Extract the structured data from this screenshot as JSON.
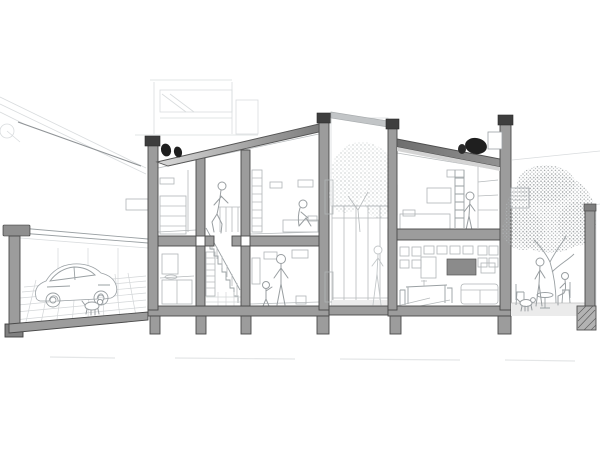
{
  "meta": {
    "title": "Architectural sectional perspective drawing of a two-storey house",
    "drawing_type": "building cross-section, monochrome line drawing",
    "canvas": {
      "width": 600,
      "height": 450,
      "background": "#ffffff"
    },
    "alt": "Black-and-white architectural section: carport with car at left, two-storey dwelling with staircase, bathroom and bedrooms, planted courtyard, living-dining room, loft bedroom, and right garden with large tree, outdoor furniture, people and a dog. Cut walls in grey with dark caps, footings below ground, rooftop equipment in black."
  },
  "palette": {
    "wall_poche": "#9c9c9c",
    "wall_outline": "#4a4a4a",
    "wall_cap": "#3e3e3e",
    "roof_gradient_light": "#d8d8d8",
    "roof_gradient_dark": "#7d7d7d",
    "roof_right_dark": "#707070",
    "equipment_black": "#1f1f1f",
    "interior_line": "#b6babc",
    "background_line": "#d9dcde",
    "foliage_dot": "#a9adaf",
    "ground_tint": "#ebebeb"
  },
  "scene": {
    "zones": [
      {
        "name": "neighbor-roof",
        "desc": "faint sloping roof of adjacent building, upper left"
      },
      {
        "name": "carport",
        "desc": "open garage with car, small dog and tiled perspective floor"
      },
      {
        "name": "left-building",
        "desc": "two-storey volume: bathroom, stair hall, family room below; bedrooms above"
      },
      {
        "name": "courtyard",
        "desc": "glazed lightwell with tree and faint figure"
      },
      {
        "name": "right-building",
        "desc": "loft bedroom over living-dining room with bookshelf wall"
      },
      {
        "name": "garden",
        "desc": "right garden with large stippled tree, table, chairs, figures, dog, boundary wall"
      }
    ],
    "figures": [
      {
        "name": "figure-climbing-stairs",
        "location": "stair hall, upper flight"
      },
      {
        "name": "figure-sitting-bedroom",
        "location": "upper bedroom, seated on bed"
      },
      {
        "name": "figure-adult-standing",
        "location": "ground-floor family room"
      },
      {
        "name": "figure-child",
        "location": "ground-floor family room"
      },
      {
        "name": "figure-courtyard",
        "location": "behind courtyard glazing"
      },
      {
        "name": "figure-bedroom-right",
        "location": "right loft bedroom"
      },
      {
        "name": "figure-garden-standing",
        "location": "garden under tree"
      },
      {
        "name": "figure-garden-sitting",
        "location": "garden chair"
      }
    ],
    "animals": [
      {
        "name": "garage-dog",
        "location": "beside car"
      },
      {
        "name": "garden-dog",
        "location": "near garden table"
      }
    ],
    "objects": [
      "car",
      "staircase",
      "bed",
      "wardrobe",
      "bookshelf",
      "dining-table",
      "sofa",
      "roof-vent-units",
      "rooftop-ac-unit",
      "garden-table",
      "garden-chairs"
    ],
    "trees": 2,
    "storeys": 2
  }
}
